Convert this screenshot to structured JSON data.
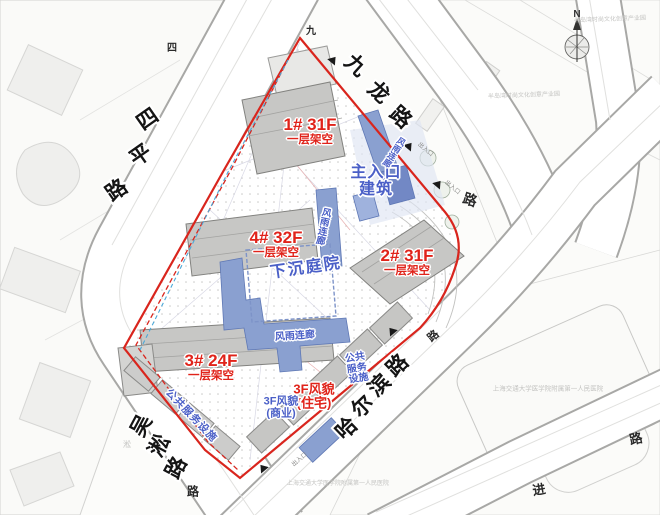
{
  "roads": {
    "siping": {
      "name": "四平路",
      "chars": [
        "四",
        "平",
        "路"
      ],
      "small": "四"
    },
    "jiulong": {
      "name": "九龙路",
      "chars": [
        "九",
        "龙",
        "路"
      ],
      "small": "九",
      "mid": "路"
    },
    "haerbin": {
      "name": "哈尔滨路",
      "chars": [
        "哈",
        "尔",
        "滨",
        "路"
      ],
      "small": "路"
    },
    "wusong": {
      "name": "吴淞路",
      "chars": [
        "吴",
        "淞",
        "路"
      ],
      "small": "路",
      "tiny": "淞"
    },
    "wujin": {
      "chars": [
        "进",
        "路"
      ]
    }
  },
  "buildings": {
    "b1": {
      "title": "1# 31F",
      "sub": "一层架空"
    },
    "b2": {
      "title": "2# 31F",
      "sub": "一层架空"
    },
    "b3": {
      "title": "3# 24F",
      "sub": "一层架空"
    },
    "b4": {
      "title": "4# 32F",
      "sub": "一层架空"
    }
  },
  "features": {
    "main_entrance": {
      "line1": "主入口",
      "line2": "建筑"
    },
    "sunken_courtyard": "下沉庭院",
    "canopy_corridor": "风雨连廊",
    "public_service": "公共服务设施",
    "public_service_lines": [
      "公共",
      "服务",
      "设施"
    ],
    "heritage_res": {
      "line1": "3F风貌",
      "line2": "(住宅)"
    },
    "heritage_com": {
      "line1": "3F风貌",
      "line2": "(商业)"
    }
  },
  "compass": {
    "label": "N"
  },
  "annotations": {
    "park": "半岛湾时尚文化创意产业园",
    "hospital": "上海交通大学医学院附属第一人民医院",
    "entrance": "出入口"
  },
  "colors": {
    "boundary_red": "#d9251d",
    "label_red": "#e0231a",
    "label_blue": "#4a5fc7",
    "corridor_fill": "#8aa0d0",
    "building_gray": "#c7c7c5"
  }
}
